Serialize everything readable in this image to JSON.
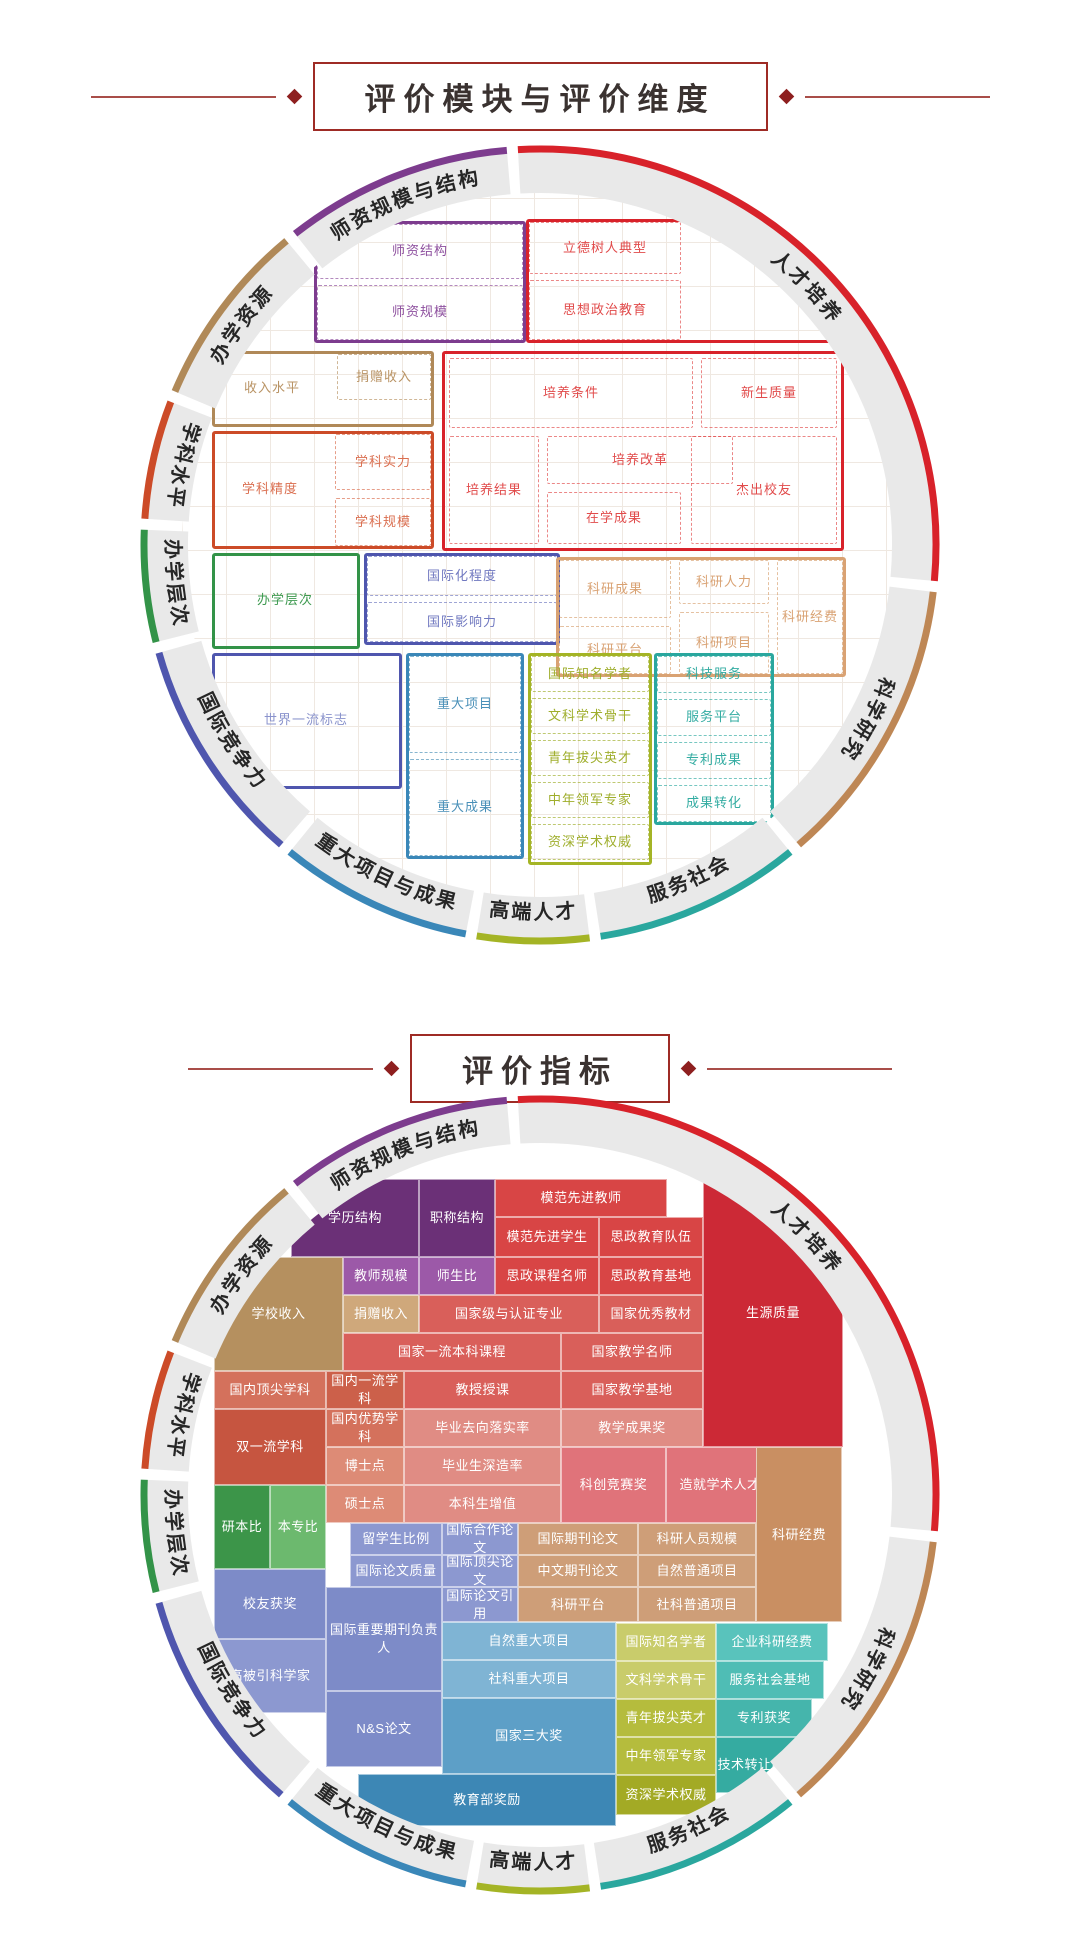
{
  "titles": {
    "section1": "评价模块与评价维度",
    "section2": "评价指标"
  },
  "decor": {
    "line_color": "#A94E49",
    "diamond_color": "#8E1F1F",
    "box_border": "#9E2B25",
    "ring_band": "#E9E9E9",
    "ring_label_color": "#262626",
    "title_color": "#3A3230"
  },
  "ring_modules": [
    {
      "label": "人才培养",
      "color": "#D8222A",
      "a0": -4,
      "a1": 96
    },
    {
      "label": "科学研究",
      "color": "#BE8755",
      "a0": 96,
      "a1": 140
    },
    {
      "label": "服务社会",
      "color": "#2AA79E",
      "a0": 140,
      "a1": 172
    },
    {
      "label": "高端人才",
      "color": "#A4B425",
      "a0": 172,
      "a1": 190
    },
    {
      "label": "重大项目与成果",
      "color": "#3A87B8",
      "a0": 190,
      "a1": 220
    },
    {
      "label": "国际竞争力",
      "color": "#4F56AE",
      "a0": 220,
      "a1": 255
    },
    {
      "label": "办学层次",
      "color": "#339348",
      "a0": 255,
      "a1": 273
    },
    {
      "label": "学科水平",
      "color": "#CC4B28",
      "a0": 273,
      "a1": 292
    },
    {
      "label": "办学资源",
      "color": "#B08958",
      "a0": 292,
      "a1": 321
    },
    {
      "label": "师资规模与结构",
      "color": "#7D3C8E",
      "a0": 321,
      "a1": 356
    }
  ],
  "module_diagram": {
    "groups": [
      {
        "name": "师资规模与结构",
        "color": "#7D3C8E",
        "textColor": "#8D4F9E",
        "box": [
          132,
          34,
          212,
          122
        ],
        "cells": [
          {
            "t": "师资结构",
            "x": 132,
            "y": 34,
            "w": 212,
            "h": 61
          },
          {
            "t": "师资规模",
            "x": 132,
            "y": 95,
            "w": 212,
            "h": 61
          }
        ]
      },
      {
        "name": "人才培养-上",
        "color": "#D8222A",
        "textColor": "#E14B4B",
        "box": [
          344,
          32,
          318,
          124
        ],
        "cells": [
          {
            "t": "立德树人典型",
            "x": 344,
            "y": 32,
            "w": 158,
            "h": 58
          },
          {
            "t": "思想政治教育",
            "x": 344,
            "y": 90,
            "w": 158,
            "h": 66
          }
        ]
      },
      {
        "name": "办学资源",
        "color": "#B08958",
        "textColor": "#B99364",
        "box": [
          30,
          164,
          222,
          76
        ],
        "cells": [
          {
            "t": "收入水平",
            "x": 30,
            "y": 164,
            "w": 122,
            "h": 76,
            "nob": true
          },
          {
            "t": "捐赠收入",
            "x": 152,
            "y": 164,
            "w": 100,
            "h": 52
          }
        ]
      },
      {
        "name": "人才培养-主",
        "color": "#D8222A",
        "textColor": "#E14B4B",
        "box": [
          260,
          164,
          402,
          200
        ],
        "cells": [
          {
            "t": "培养条件",
            "x": 264,
            "y": 168,
            "w": 250,
            "h": 76
          },
          {
            "t": "新生质量",
            "x": 516,
            "y": 168,
            "w": 142,
            "h": 76
          },
          {
            "t": "培养改革",
            "x": 362,
            "y": 246,
            "w": 192,
            "h": 54
          },
          {
            "t": "培养结果",
            "x": 264,
            "y": 246,
            "w": 96,
            "h": 114
          },
          {
            "t": "在学成果",
            "x": 362,
            "y": 302,
            "w": 140,
            "h": 58
          },
          {
            "t": "杰出校友",
            "x": 506,
            "y": 246,
            "w": 152,
            "h": 114
          }
        ]
      },
      {
        "name": "学科水平",
        "color": "#CC4B28",
        "textColor": "#DA6E4F",
        "box": [
          30,
          244,
          222,
          118
        ],
        "cells": [
          {
            "t": "学科精度",
            "x": 30,
            "y": 244,
            "w": 118,
            "h": 118,
            "nob": true
          },
          {
            "t": "学科实力",
            "x": 150,
            "y": 244,
            "w": 102,
            "h": 62
          },
          {
            "t": "学科规模",
            "x": 150,
            "y": 308,
            "w": 102,
            "h": 54
          }
        ]
      },
      {
        "name": "办学层次",
        "color": "#339348",
        "textColor": "#3E9A50",
        "box": [
          30,
          366,
          148,
          96
        ],
        "cells": [
          {
            "t": "办学层次",
            "x": 30,
            "y": 366,
            "w": 148,
            "h": 96,
            "nob": true
          }
        ]
      },
      {
        "name": "国际竞争力-上",
        "color": "#4F56AE",
        "textColor": "#7078C0",
        "box": [
          182,
          366,
          196,
          92
        ],
        "cells": [
          {
            "t": "国际化程度",
            "x": 182,
            "y": 366,
            "w": 196,
            "h": 46
          },
          {
            "t": "国际影响力",
            "x": 182,
            "y": 412,
            "w": 196,
            "h": 46
          }
        ]
      },
      {
        "name": "科学研究",
        "color": "#D9A273",
        "textColor": "#D9A273",
        "box": [
          374,
          370,
          290,
          120
        ],
        "cells": [
          {
            "t": "科研成果",
            "x": 374,
            "y": 370,
            "w": 118,
            "h": 64
          },
          {
            "t": "科研平台",
            "x": 374,
            "y": 436,
            "w": 118,
            "h": 54
          },
          {
            "t": "科研人力",
            "x": 494,
            "y": 370,
            "w": 96,
            "h": 50
          },
          {
            "t": "科研项目",
            "x": 494,
            "y": 422,
            "w": 96,
            "h": 68
          },
          {
            "t": "科研经费",
            "x": 592,
            "y": 370,
            "w": 72,
            "h": 120
          }
        ]
      },
      {
        "name": "国际竞争力-下",
        "color": "#4F56AE",
        "textColor": "#8A93CC",
        "box": [
          30,
          466,
          190,
          136
        ],
        "cells": [
          {
            "t": "世界一流标志",
            "x": 30,
            "y": 466,
            "w": 190,
            "h": 136,
            "nob": true
          }
        ]
      },
      {
        "name": "重大项目与成果",
        "color": "#3A87B8",
        "textColor": "#4A90B8",
        "box": [
          224,
          466,
          118,
          206
        ],
        "cells": [
          {
            "t": "重大项目",
            "x": 224,
            "y": 466,
            "w": 118,
            "h": 103
          },
          {
            "t": "重大成果",
            "x": 224,
            "y": 569,
            "w": 118,
            "h": 103
          }
        ]
      },
      {
        "name": "高端人才",
        "color": "#A4B425",
        "textColor": "#9FAE2C",
        "box": [
          346,
          466,
          124,
          212
        ],
        "cells": [
          {
            "t": "国际知名学者",
            "x": 346,
            "y": 466,
            "w": 124,
            "h": 42
          },
          {
            "t": "文科学术骨干",
            "x": 346,
            "y": 508,
            "w": 124,
            "h": 42
          },
          {
            "t": "青年拔尖英才",
            "x": 346,
            "y": 550,
            "w": 124,
            "h": 42
          },
          {
            "t": "中年领军专家",
            "x": 346,
            "y": 592,
            "w": 124,
            "h": 42
          },
          {
            "t": "资深学术权威",
            "x": 346,
            "y": 634,
            "w": 124,
            "h": 42
          }
        ]
      },
      {
        "name": "服务社会",
        "color": "#2AA79E",
        "textColor": "#33ACA2",
        "box": [
          472,
          466,
          120,
          172
        ],
        "cells": [
          {
            "t": "科技服务",
            "x": 472,
            "y": 466,
            "w": 120,
            "h": 43
          },
          {
            "t": "服务平台",
            "x": 472,
            "y": 509,
            "w": 120,
            "h": 43
          },
          {
            "t": "专利成果",
            "x": 472,
            "y": 552,
            "w": 120,
            "h": 43
          },
          {
            "t": "成果转化",
            "x": 472,
            "y": 595,
            "w": 120,
            "h": 43
          }
        ]
      }
    ]
  },
  "indicator_diagram": {
    "cells": [
      {
        "t": "学历结构",
        "x": 109,
        "y": 42,
        "w": 128,
        "h": 78,
        "c": "#6B3077"
      },
      {
        "t": "职称结构",
        "x": 237,
        "y": 42,
        "w": 76,
        "h": 78,
        "c": "#6B3077"
      },
      {
        "t": "模范先进教师",
        "x": 313,
        "y": 42,
        "w": 172,
        "h": 38,
        "c": "#D84545"
      },
      {
        "t": "模范先进学生",
        "x": 313,
        "y": 80,
        "w": 104,
        "h": 40,
        "c": "#D84545"
      },
      {
        "t": "思政教育队伍",
        "x": 417,
        "y": 80,
        "w": 104,
        "h": 40,
        "c": "#D84545"
      },
      {
        "t": "教师规模",
        "x": 161,
        "y": 120,
        "w": 76,
        "h": 38,
        "c": "#9C59A8"
      },
      {
        "t": "师生比",
        "x": 237,
        "y": 120,
        "w": 76,
        "h": 38,
        "c": "#9C59A8"
      },
      {
        "t": "思政课程名师",
        "x": 313,
        "y": 120,
        "w": 104,
        "h": 38,
        "c": "#D84545"
      },
      {
        "t": "思政教育基地",
        "x": 417,
        "y": 120,
        "w": 104,
        "h": 38,
        "c": "#D84545"
      },
      {
        "t": "学校收入",
        "x": 32,
        "y": 120,
        "w": 129,
        "h": 114,
        "c": "#B5905F"
      },
      {
        "t": "捐赠收入",
        "x": 161,
        "y": 158,
        "w": 76,
        "h": 38,
        "c": "#CFA87B"
      },
      {
        "t": "国家级与认证专业",
        "x": 237,
        "y": 158,
        "w": 180,
        "h": 38,
        "c": "#D95F5A"
      },
      {
        "t": "国家优秀教材",
        "x": 417,
        "y": 158,
        "w": 104,
        "h": 38,
        "c": "#D95F5A"
      },
      {
        "t": "国家一流本科课程",
        "x": 161,
        "y": 196,
        "w": 218,
        "h": 38,
        "c": "#D95F5A"
      },
      {
        "t": "国家教学名师",
        "x": 379,
        "y": 196,
        "w": 142,
        "h": 38,
        "c": "#D95F5A"
      },
      {
        "t": "生源质量",
        "x": 521,
        "y": 42,
        "w": 140,
        "h": 268,
        "c": "#CC2936"
      },
      {
        "t": "国内顶尖学科",
        "x": 32,
        "y": 234,
        "w": 112,
        "h": 38,
        "c": "#D4715C"
      },
      {
        "t": "国内一流学科",
        "x": 144,
        "y": 234,
        "w": 78,
        "h": 38,
        "c": "#CC604A"
      },
      {
        "t": "教授授课",
        "x": 222,
        "y": 234,
        "w": 157,
        "h": 38,
        "c": "#D95F5A"
      },
      {
        "t": "国家教学基地",
        "x": 379,
        "y": 234,
        "w": 142,
        "h": 38,
        "c": "#D95F5A"
      },
      {
        "t": "双一流学科",
        "x": 32,
        "y": 272,
        "w": 112,
        "h": 76,
        "c": "#C65540"
      },
      {
        "t": "国内优势学科",
        "x": 144,
        "y": 272,
        "w": 78,
        "h": 38,
        "c": "#D4715C"
      },
      {
        "t": "毕业去向落实率",
        "x": 222,
        "y": 272,
        "w": 157,
        "h": 38,
        "c": "#E08C84"
      },
      {
        "t": "教学成果奖",
        "x": 379,
        "y": 272,
        "w": 142,
        "h": 38,
        "c": "#E08C84"
      },
      {
        "t": "博士点",
        "x": 144,
        "y": 310,
        "w": 78,
        "h": 38,
        "c": "#DD8B76"
      },
      {
        "t": "毕业生深造率",
        "x": 222,
        "y": 310,
        "w": 157,
        "h": 38,
        "c": "#E08C84"
      },
      {
        "t": "硕士点",
        "x": 144,
        "y": 348,
        "w": 78,
        "h": 38,
        "c": "#DD8B76"
      },
      {
        "t": "本科生增值",
        "x": 222,
        "y": 348,
        "w": 157,
        "h": 38,
        "c": "#E08C84"
      },
      {
        "t": "科创竞赛奖",
        "x": 379,
        "y": 310,
        "w": 105,
        "h": 76,
        "c": "#E0737A"
      },
      {
        "t": "造就学术人才",
        "x": 484,
        "y": 310,
        "w": 108,
        "h": 76,
        "c": "#E0737A"
      },
      {
        "t": "本专比",
        "x": 88,
        "y": 348,
        "w": 56,
        "h": 84,
        "c": "#6CB96E"
      },
      {
        "t": "研本比",
        "x": 32,
        "y": 348,
        "w": 56,
        "h": 84,
        "c": "#3C9549"
      },
      {
        "t": "留学生比例",
        "x": 168,
        "y": 386,
        "w": 92,
        "h": 32,
        "c": "#8C98D0"
      },
      {
        "t": "国际合作论文",
        "x": 260,
        "y": 386,
        "w": 76,
        "h": 32,
        "c": "#8C98D0"
      },
      {
        "t": "国际期刊论文",
        "x": 336,
        "y": 386,
        "w": 120,
        "h": 32,
        "c": "#CE9E78"
      },
      {
        "t": "科研人员规模",
        "x": 456,
        "y": 386,
        "w": 118,
        "h": 32,
        "c": "#CE9E78"
      },
      {
        "t": "国际论文质量",
        "x": 168,
        "y": 418,
        "w": 92,
        "h": 32,
        "c": "#8C98D0"
      },
      {
        "t": "国际顶尖论文",
        "x": 260,
        "y": 418,
        "w": 76,
        "h": 32,
        "c": "#8C98D0"
      },
      {
        "t": "中文期刊论文",
        "x": 336,
        "y": 418,
        "w": 120,
        "h": 32,
        "c": "#CE9E78"
      },
      {
        "t": "自然普通项目",
        "x": 456,
        "y": 418,
        "w": 118,
        "h": 32,
        "c": "#CE9E78"
      },
      {
        "t": "校友获奖",
        "x": 32,
        "y": 432,
        "w": 112,
        "h": 70,
        "c": "#7D8BC8"
      },
      {
        "t": "国际论文引用",
        "x": 260,
        "y": 450,
        "w": 76,
        "h": 35,
        "c": "#8C98D0"
      },
      {
        "t": "科研平台",
        "x": 336,
        "y": 450,
        "w": 120,
        "h": 35,
        "c": "#CE9E78"
      },
      {
        "t": "社科普通项目",
        "x": 456,
        "y": 450,
        "w": 118,
        "h": 35,
        "c": "#CE9E78"
      },
      {
        "t": "科研经费",
        "x": 574,
        "y": 310,
        "w": 86,
        "h": 175,
        "c": "#C98F62"
      },
      {
        "t": "国际重要期刊负责人",
        "x": 144,
        "y": 450,
        "w": 116,
        "h": 104,
        "c": "#7D8BC8"
      },
      {
        "t": "高被引科学家",
        "x": 32,
        "y": 502,
        "w": 112,
        "h": 74,
        "c": "#8C98D0"
      },
      {
        "t": "自然重大项目",
        "x": 260,
        "y": 485,
        "w": 174,
        "h": 38,
        "c": "#7FB4D4"
      },
      {
        "t": "社科重大项目",
        "x": 260,
        "y": 523,
        "w": 174,
        "h": 38,
        "c": "#7FB4D4"
      },
      {
        "t": "国际知名学者",
        "x": 434,
        "y": 486,
        "w": 100,
        "h": 38,
        "c": "#C9CC6B"
      },
      {
        "t": "企业科研经费",
        "x": 534,
        "y": 486,
        "w": 112,
        "h": 38,
        "c": "#59C3BC"
      },
      {
        "t": "文科学术骨干",
        "x": 434,
        "y": 524,
        "w": 100,
        "h": 38,
        "c": "#C9CC6B"
      },
      {
        "t": "服务社会基地",
        "x": 534,
        "y": 524,
        "w": 108,
        "h": 38,
        "c": "#4FBDB5"
      },
      {
        "t": "N&S论文",
        "x": 144,
        "y": 554,
        "w": 116,
        "h": 76,
        "c": "#7D8BC8"
      },
      {
        "t": "国家三大奖",
        "x": 260,
        "y": 561,
        "w": 174,
        "h": 76,
        "c": "#5D9FC7"
      },
      {
        "t": "青年拔尖英才",
        "x": 434,
        "y": 562,
        "w": 100,
        "h": 38,
        "c": "#B5BC3D"
      },
      {
        "t": "专利获奖",
        "x": 534,
        "y": 562,
        "w": 96,
        "h": 38,
        "c": "#45B5AC"
      },
      {
        "t": "中年领军专家",
        "x": 434,
        "y": 600,
        "w": 100,
        "h": 38,
        "c": "#B5BC3D"
      },
      {
        "t": "技术转让收入",
        "x": 534,
        "y": 600,
        "w": 84,
        "h": 56,
        "c": "#35ABA1"
      },
      {
        "t": "资深学术权威",
        "x": 434,
        "y": 638,
        "w": 100,
        "h": 40,
        "c": "#A3AA25"
      },
      {
        "t": "教育部奖励",
        "x": 176,
        "y": 637,
        "w": 258,
        "h": 52,
        "c": "#3D87B5"
      }
    ]
  }
}
